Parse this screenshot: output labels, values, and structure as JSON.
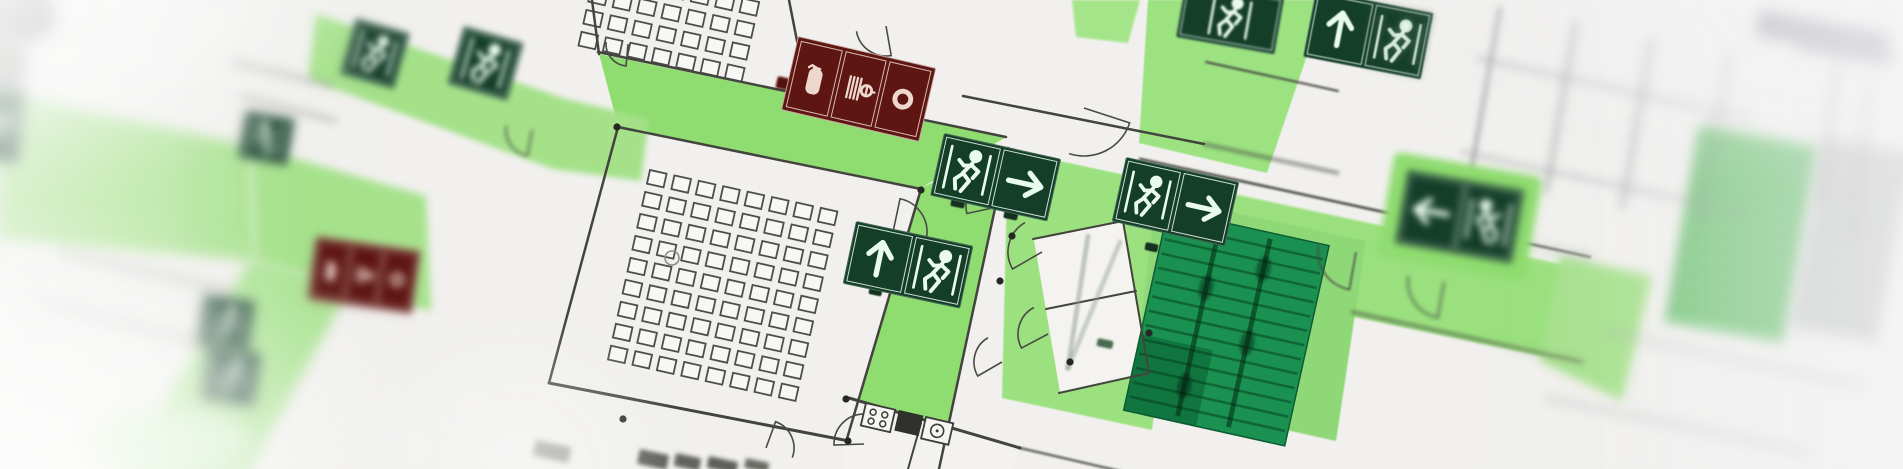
{
  "scene": {
    "kind": "photograph-of-evacuation-floor-plan",
    "focus_region": "center",
    "camera_tilt_deg": 12
  },
  "palette": {
    "paper": "#f1f0ee",
    "line": "#44443f",
    "route_green": "#8fdc70",
    "route_green_soft": "#a7e28c",
    "exit_sign_green": "#153e29",
    "exit_glyph": "#e9fbee",
    "stair_green": "#1a9150",
    "fire_sign_red": "#5e1613",
    "fire_glyph": "#eed7cd"
  },
  "legend": {
    "escape_route": "light-green highlighted corridors",
    "exit_sign": "dark green square, white running-man and arrow pictograms",
    "fire_equipment_sign": "dark red strip: extinguisher, hose reel, alarm ring",
    "stairwell": "saturated green with tread lines"
  },
  "routes": [
    {
      "pts": [
        [
          599,
          54
        ],
        [
          1006,
          137
        ],
        [
          921,
          188
        ],
        [
          618,
          126
        ]
      ],
      "fill": "#8fdc70",
      "blur": 0
    },
    {
      "pts": [
        [
          921,
          188
        ],
        [
          1008,
          148
        ],
        [
          940,
          469
        ],
        [
          852,
          469
        ],
        [
          846,
          442
        ]
      ],
      "fill": "#8fdc70",
      "blur": 0
    },
    {
      "pts": [
        [
          1008,
          150
        ],
        [
          1186,
          188
        ],
        [
          1152,
          430
        ],
        [
          1002,
          398
        ]
      ],
      "fill": "#9ce180",
      "blur": 0.5
    },
    {
      "pts": [
        [
          1150,
          176
        ],
        [
          1588,
          270
        ],
        [
          1568,
          362
        ],
        [
          1132,
          270
        ]
      ],
      "fill": "#9ae07e",
      "blur": 1
    },
    {
      "pts": [
        [
          1156,
          196
        ],
        [
          1366,
          241
        ],
        [
          1336,
          441
        ],
        [
          1132,
          396
        ]
      ],
      "fill": "#8fd877",
      "blur": 0.5
    },
    {
      "pts": [
        [
          1148,
          0
        ],
        [
          1326,
          0
        ],
        [
          1267,
          173
        ],
        [
          1139,
          143
        ]
      ],
      "fill": "#9ce281",
      "blur": 0.5
    },
    {
      "pts": [
        [
          1072,
          0
        ],
        [
          1140,
          0
        ],
        [
          1128,
          43
        ],
        [
          1076,
          37
        ]
      ],
      "fill": "#a5e58a",
      "blur": 1
    },
    {
      "pts": [
        [
          1560,
          256
        ],
        [
          1652,
          276
        ],
        [
          1622,
          401
        ],
        [
          1540,
          361
        ]
      ],
      "fill": "#a8e18f",
      "blur": 4
    },
    {
      "pts": [
        [
          0,
          92
        ],
        [
          251,
          146
        ],
        [
          256,
          261
        ],
        [
          0,
          239
        ]
      ],
      "fill": "#abe392",
      "blur": 5
    },
    {
      "pts": [
        [
          251,
          146
        ],
        [
          426,
          196
        ],
        [
          431,
          311
        ],
        [
          256,
          261
        ]
      ],
      "fill": "#a6e28c",
      "blur": 4
    },
    {
      "pts": [
        [
          251,
          259
        ],
        [
          353,
          283
        ],
        [
          249,
          469
        ],
        [
          119,
          469
        ],
        [
          141,
          441
        ]
      ],
      "fill": "#ade495",
      "blur": 5
    },
    {
      "pts": [
        [
          316,
          14
        ],
        [
          566,
          99
        ],
        [
          649,
          119
        ],
        [
          641,
          181
        ],
        [
          553,
          169
        ],
        [
          308,
          79
        ]
      ],
      "fill": "#a4e189",
      "blur": 3
    }
  ],
  "white_rooms": [
    {
      "pts": [
        [
          849,
          397
        ],
        [
          1021,
          447
        ],
        [
          1012,
          469
        ],
        [
          843,
          469
        ]
      ],
      "fill": "#f3f2ef",
      "blur": 0
    },
    {
      "pts": [
        [
          1034,
          240
        ],
        [
          1122,
          222
        ],
        [
          1148,
          372
        ],
        [
          1060,
          392
        ]
      ],
      "fill": "#f4f3f0",
      "blur": 0
    }
  ],
  "stairwells": [
    {
      "x": 1168,
      "y": 210,
      "w": 165,
      "h": 205,
      "rot": 12.5,
      "fill": "#1a9150",
      "stroke": "#0d5c33",
      "treads": 13,
      "tread_color": "rgba(4,60,28,0.5)",
      "rails": [
        54,
        106
      ],
      "rail_color": "rgba(3,40,18,0.55)",
      "blur": 0,
      "blobs": [
        [
          54,
          0.33
        ],
        [
          106,
          0.55
        ],
        [
          54,
          0.82
        ],
        [
          106,
          0.18
        ]
      ],
      "landing": "rgba(8,90,45,0.5)"
    },
    {
      "x": 1700,
      "y": 126,
      "w": 118,
      "h": 198,
      "rot": 10,
      "fill": "#83cf86",
      "stroke": "#5ea863",
      "treads": 12,
      "tread_color": "rgba(30,90,45,0.45)",
      "rails": [],
      "blur": 4,
      "blobs": [],
      "landing": ""
    },
    {
      "x": 1826,
      "y": 138,
      "w": 84,
      "h": 192,
      "rot": 10,
      "fill": "#d3d5d4",
      "stroke": "#b0b3b2",
      "treads": 12,
      "tread_color": "#a2a5a6",
      "rails": [],
      "blur": 4.5,
      "blobs": [],
      "landing": ""
    }
  ],
  "seat_grids": [
    {
      "x": 650,
      "y": 170,
      "rot": 12.5,
      "cols": 8,
      "rows": 9,
      "px": 25,
      "py": 22.5,
      "w": 17,
      "h": 14
    },
    {
      "x": 601,
      "y": -56,
      "rot": 12.5,
      "cols": 7,
      "rows": 5,
      "px": 25,
      "py": 22.5,
      "w": 17,
      "h": 14
    }
  ],
  "walls": [
    [
      598,
      52,
      1006,
      137,
      2.5,
      0
    ],
    [
      618,
      127,
      921,
      189,
      2.5,
      0
    ],
    [
      618,
      127,
      549,
      383,
      2.5,
      0
    ],
    [
      549,
      383,
      849,
      441,
      3,
      0
    ],
    [
      921,
      189,
      846,
      442,
      2.5,
      0
    ],
    [
      1008,
      148,
      939,
      469,
      2.5,
      0
    ],
    [
      592,
      0,
      599,
      54,
      2.5,
      0
    ],
    [
      789,
      0,
      807,
      92,
      2.5,
      0
    ],
    [
      963,
      96,
      1204,
      144,
      2.5,
      0
    ],
    [
      1204,
      144,
      1338,
      173,
      2,
      2
    ],
    [
      1033,
      239,
      1123,
      221,
      2,
      0
    ],
    [
      1123,
      221,
      1149,
      373,
      2,
      0
    ],
    [
      1059,
      393,
      1149,
      373,
      2,
      0
    ],
    [
      1046,
      309,
      1136,
      291,
      2,
      0
    ],
    [
      849,
      398,
      1020,
      448,
      3,
      0
    ],
    [
      1020,
      448,
      1150,
      478,
      2,
      1
    ],
    [
      921,
      423,
      908,
      469,
      2,
      0
    ],
    [
      1140,
      159,
      1590,
      257,
      2.5,
      1
    ],
    [
      1352,
      312,
      1582,
      362,
      2,
      2
    ],
    [
      1206,
      62,
      1338,
      91,
      2,
      1
    ],
    [
      1500,
      8,
      1470,
      178,
      2.5,
      3,
      "#86868a"
    ],
    [
      1576,
      22,
      1546,
      192,
      2.5,
      4,
      "#8e8e92"
    ],
    [
      1652,
      38,
      1622,
      208,
      2.5,
      4,
      "#8e8e92"
    ],
    [
      1730,
      54,
      1700,
      224,
      2.5,
      5,
      "#96969a"
    ],
    [
      1462,
      152,
      1748,
      214,
      2,
      4,
      "#9a9a9e"
    ],
    [
      1478,
      58,
      1750,
      119,
      2,
      4,
      "#9a9a9e"
    ],
    [
      1545,
      398,
      1808,
      452,
      2,
      5,
      "#aaaaac"
    ],
    [
      1605,
      332,
      1862,
      386,
      2,
      5,
      "#aaaaac"
    ],
    [
      62,
      252,
      232,
      292,
      3,
      5,
      "#9a9a98"
    ],
    [
      42,
      302,
      212,
      346,
      3,
      5,
      "#a2a2a0"
    ],
    [
      232,
      62,
      332,
      86,
      2.5,
      4,
      "#8e8e8c"
    ],
    [
      242,
      96,
      336,
      121,
      2.5,
      4,
      "#96968c"
    ],
    [
      1838,
      60,
      1820,
      200,
      3,
      5,
      "#a0a0a4"
    ],
    [
      1870,
      80,
      1852,
      240,
      3,
      5,
      "#ababaf"
    ],
    [
      1088,
      236,
      1068,
      368,
      5,
      1,
      "#8c9a8e",
      0.5
    ],
    [
      1068,
      368,
      1120,
      242,
      5,
      1,
      "#93a095",
      0.45
    ]
  ],
  "arcs": [
    [
      1016,
      150,
      40,
      95,
      185,
      0
    ],
    [
      1002,
      206,
      36,
      168,
      258,
      0
    ],
    [
      893,
      232,
      34,
      -78,
      12,
      0
    ],
    [
      886,
      26,
      30,
      80,
      170,
      0
    ],
    [
      628,
      44,
      22,
      95,
      185,
      0
    ],
    [
      1042,
      252,
      34,
      150,
      240,
      0
    ],
    [
      1048,
      334,
      30,
      152,
      242,
      0
    ],
    [
      1002,
      362,
      28,
      150,
      240,
      0
    ],
    [
      1356,
      252,
      38,
      100,
      190,
      1
    ],
    [
      1444,
      282,
      36,
      100,
      190,
      2
    ],
    [
      1084,
      108,
      48,
      18,
      108,
      0
    ],
    [
      864,
      444,
      30,
      178,
      268,
      0
    ],
    [
      766,
      448,
      28,
      -70,
      20,
      0
    ],
    [
      532,
      130,
      26,
      100,
      190,
      2
    ]
  ],
  "columns": [
    [
      623,
      419
    ],
    [
      848,
      441
    ],
    [
      1012,
      236
    ],
    [
      1000,
      281
    ],
    [
      1070,
      362
    ],
    [
      921,
      190
    ],
    [
      798,
      93
    ],
    [
      846,
      399
    ],
    [
      1149,
      333
    ],
    [
      617,
      127
    ]
  ],
  "circle_markers": [
    [
      672,
      258,
      7
    ]
  ],
  "fixtures": [
    {
      "type": "stove",
      "x": 866,
      "y": 403,
      "w": 30,
      "h": 23,
      "rot": 13
    },
    {
      "type": "dark",
      "x": 899,
      "y": 410,
      "w": 25,
      "h": 21,
      "rot": 13
    },
    {
      "type": "sink",
      "x": 926,
      "y": 417,
      "w": 28,
      "h": 22,
      "rot": 13
    }
  ],
  "smudges": [
    {
      "k": "e",
      "x": 20,
      "y": 16,
      "w": 36,
      "h": 26,
      "fill": "#6f6f6b",
      "blur": 6,
      "rot": 0
    },
    {
      "k": "e",
      "x": 6,
      "y": 62,
      "w": 20,
      "h": 32,
      "fill": "#90908c",
      "blur": 6,
      "rot": 0
    },
    {
      "k": "r",
      "x": 1760,
      "y": 10,
      "w": 132,
      "h": 26,
      "fill": "#9b9ba1",
      "blur": 5,
      "rot": 10
    },
    {
      "k": "r",
      "x": 1798,
      "y": 34,
      "w": 96,
      "h": 15,
      "fill": "#a4a4aa",
      "blur": 5,
      "rot": 10
    },
    {
      "k": "r",
      "x": 640,
      "y": 449,
      "w": 30,
      "h": 15,
      "fill": "#5a5a55",
      "blur": 2,
      "rot": 12
    },
    {
      "k": "r",
      "x": 676,
      "y": 453,
      "w": 26,
      "h": 13,
      "fill": "#63635e",
      "blur": 2,
      "rot": 12
    },
    {
      "k": "r",
      "x": 709,
      "y": 456,
      "w": 30,
      "h": 12,
      "fill": "#5f5f5a",
      "blur": 2,
      "rot": 12
    },
    {
      "k": "r",
      "x": 746,
      "y": 458,
      "w": 24,
      "h": 10,
      "fill": "#6a6a64",
      "blur": 2,
      "rot": 12
    },
    {
      "k": "r",
      "x": 536,
      "y": 440,
      "w": 36,
      "h": 16,
      "fill": "#9a9a94",
      "blur": 3,
      "rot": 12
    },
    {
      "k": "e",
      "x": 170,
      "y": 442,
      "w": 85,
      "h": 32,
      "fill": "#cfeec2",
      "blur": 8,
      "rot": 0
    },
    {
      "k": "r",
      "x": 778,
      "y": 76,
      "w": 28,
      "h": 12,
      "fill": "#54120f",
      "blur": 1,
      "rot": 13
    },
    {
      "k": "r",
      "x": 952,
      "y": 197,
      "w": 14,
      "h": 9,
      "fill": "#16301f",
      "blur": 0.5,
      "rot": 12
    },
    {
      "k": "r",
      "x": 1005,
      "y": 209,
      "w": 14,
      "h": 9,
      "fill": "#16301f",
      "blur": 0.5,
      "rot": 12
    },
    {
      "k": "r",
      "x": 870,
      "y": 286,
      "w": 13,
      "h": 8,
      "fill": "#16301f",
      "blur": 0.5,
      "rot": 12
    },
    {
      "k": "r",
      "x": 1146,
      "y": 242,
      "w": 13,
      "h": 8,
      "fill": "#16301f",
      "blur": 0.5,
      "rot": 12
    },
    {
      "k": "r",
      "x": 1098,
      "y": 338,
      "w": 16,
      "h": 8,
      "fill": "#49684f",
      "blur": 1,
      "rot": 12
    }
  ],
  "signs": [
    {
      "id": "exit-a",
      "kind": "exit",
      "x": 944,
      "y": 133,
      "w": 120,
      "h": 64,
      "rot": 12.5,
      "blur": 0,
      "panels": [
        "man-right",
        "arrow-right"
      ]
    },
    {
      "id": "exit-b",
      "kind": "exit",
      "x": 856,
      "y": 221,
      "w": 120,
      "h": 64,
      "rot": 12,
      "blur": 0,
      "panels": [
        "arrow-up",
        "man-right"
      ]
    },
    {
      "id": "exit-c",
      "kind": "exit",
      "x": 1126,
      "y": 157,
      "w": 116,
      "h": 66,
      "rot": 12.5,
      "blur": 0,
      "panels": [
        "man-right",
        "arrow-right"
      ]
    },
    {
      "id": "exit-d",
      "kind": "exit",
      "x": 1186,
      "y": -20,
      "w": 100,
      "h": 58,
      "rot": 10,
      "blur": 1,
      "panels": [
        "man-right"
      ]
    },
    {
      "id": "exit-e",
      "kind": "exit",
      "x": 1316,
      "y": -10,
      "w": 120,
      "h": 68,
      "rot": 11,
      "blur": 0.5,
      "panels": [
        "arrow-up",
        "man-right"
      ]
    },
    {
      "id": "exit-f",
      "kind": "exit",
      "x": 1408,
      "y": 170,
      "w": 118,
      "h": 74,
      "rot": 10,
      "blur": 3.5,
      "pad": true,
      "panels": [
        "arrow-left",
        "man-left"
      ]
    },
    {
      "id": "exit-g1",
      "kind": "exit",
      "x": 356,
      "y": 18,
      "w": 56,
      "h": 58,
      "rot": 16,
      "blur": 3,
      "panels": [
        "man-right"
      ]
    },
    {
      "id": "exit-g2",
      "kind": "exit",
      "x": 464,
      "y": 26,
      "w": 62,
      "h": 60,
      "rot": 16,
      "blur": 3,
      "panels": [
        "man-right"
      ]
    },
    {
      "id": "exit-h",
      "kind": "exit",
      "x": 246,
      "y": 110,
      "w": 50,
      "h": 48,
      "rot": 10,
      "blur": 4,
      "panels": [
        "man-left"
      ]
    },
    {
      "id": "exit-i1",
      "kind": "exit",
      "x": 204,
      "y": 294,
      "w": 52,
      "h": 52,
      "rot": 8,
      "blur": 4,
      "panels": [
        "man-right"
      ]
    },
    {
      "id": "exit-i2",
      "kind": "exit",
      "x": 208,
      "y": 346,
      "w": 54,
      "h": 54,
      "rot": 8,
      "blur": 4,
      "panels": [
        "man-right"
      ]
    },
    {
      "id": "exit-j",
      "kind": "exit",
      "x": -14,
      "y": 86,
      "w": 40,
      "h": 74,
      "rot": 6,
      "blur": 5,
      "panels": [
        "man-right"
      ]
    },
    {
      "id": "fire-1",
      "kind": "fire",
      "x": 798,
      "y": 36,
      "w": 142,
      "h": 76,
      "rot": 13,
      "blur": 0,
      "panels": [
        "extinguisher",
        "hose-reel",
        "ring"
      ]
    },
    {
      "id": "fire-2",
      "kind": "fire",
      "x": 316,
      "y": 236,
      "w": 106,
      "h": 64,
      "rot": 8,
      "blur": 4,
      "panels": [
        "extinguisher",
        "hose-reel",
        "ring"
      ]
    }
  ]
}
